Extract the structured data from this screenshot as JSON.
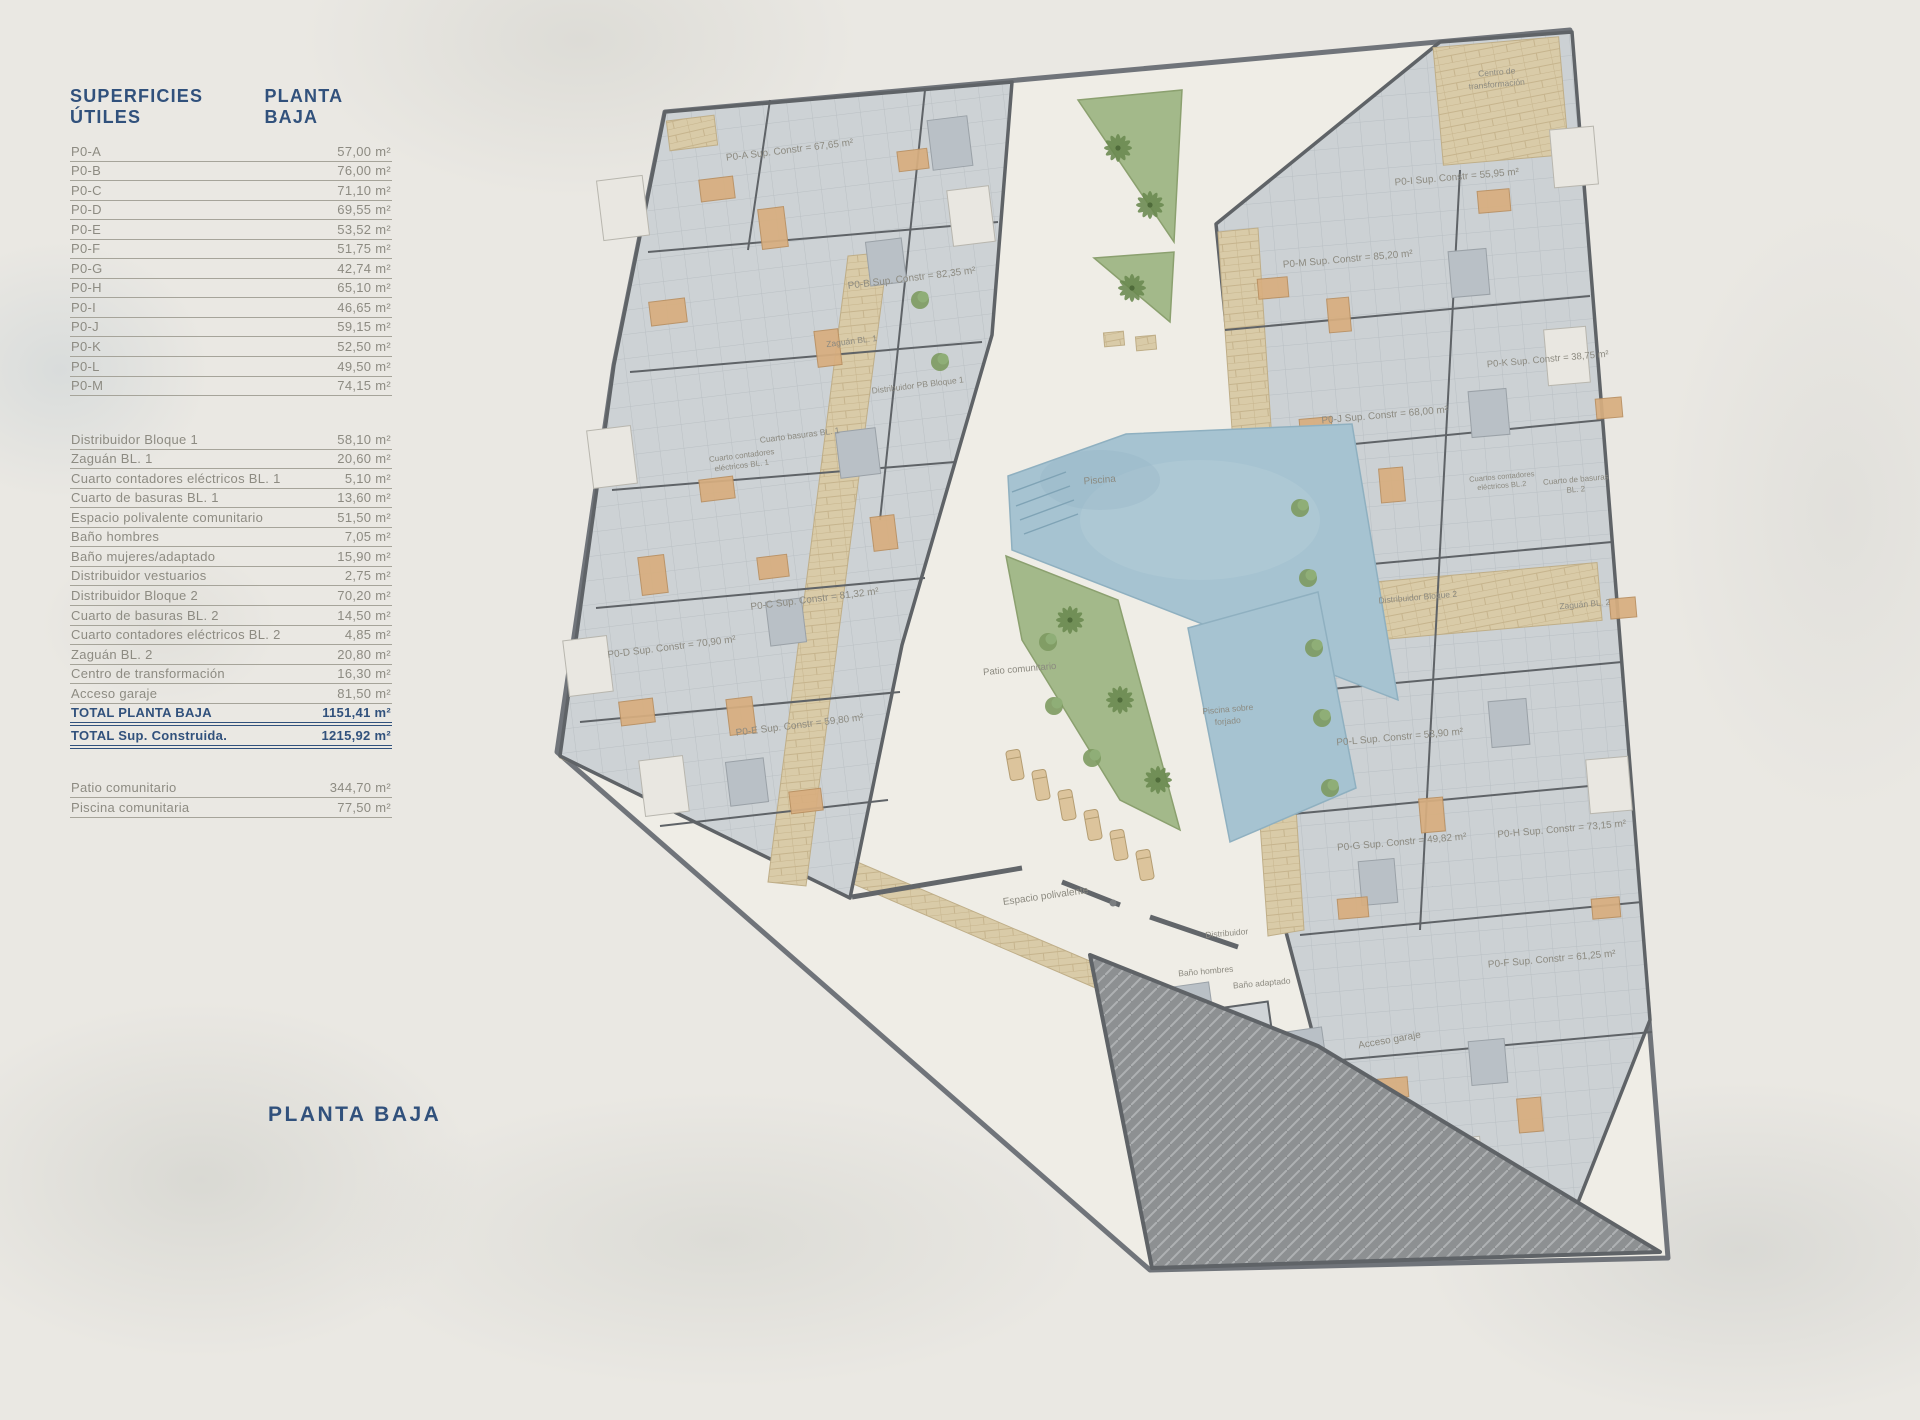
{
  "legend": {
    "title_left": "SUPERFICIES ÚTILES",
    "title_right": "PLANTA BAJA",
    "apartments": [
      {
        "label": "P0-A",
        "value": "57,00 m²"
      },
      {
        "label": "P0-B",
        "value": "76,00 m²"
      },
      {
        "label": "P0-C",
        "value": "71,10 m²"
      },
      {
        "label": "P0-D",
        "value": "69,55 m²"
      },
      {
        "label": "P0-E",
        "value": "53,52 m²"
      },
      {
        "label": "P0-F",
        "value": "51,75 m²"
      },
      {
        "label": "P0-G",
        "value": "42,74 m²"
      },
      {
        "label": "P0-H",
        "value": "65,10 m²"
      },
      {
        "label": "P0-I",
        "value": "46,65 m²"
      },
      {
        "label": "P0-J",
        "value": "59,15 m²"
      },
      {
        "label": "P0-K",
        "value": "52,50 m²"
      },
      {
        "label": "P0-L",
        "value": "49,50 m²"
      },
      {
        "label": "P0-M",
        "value": "74,15 m²"
      }
    ],
    "common": [
      {
        "label": "Distribuidor Bloque 1",
        "value": "58,10 m²"
      },
      {
        "label": "Zaguán BL. 1",
        "value": "20,60 m²"
      },
      {
        "label": "Cuarto contadores eléctricos BL. 1",
        "value": "5,10 m²"
      },
      {
        "label": "Cuarto de basuras BL. 1",
        "value": "13,60 m²"
      },
      {
        "label": "Espacio polivalente comunitario",
        "value": "51,50 m²"
      },
      {
        "label": "Baño hombres",
        "value": "7,05 m²"
      },
      {
        "label": "Baño mujeres/adaptado",
        "value": "15,90 m²"
      },
      {
        "label": "Distribuidor vestuarios",
        "value": "2,75 m²"
      },
      {
        "label": "Distribuidor Bloque 2",
        "value": "70,20 m²"
      },
      {
        "label": "Cuarto de basuras BL. 2",
        "value": "14,50 m²"
      },
      {
        "label": "Cuarto contadores eléctricos BL. 2",
        "value": "4,85 m²"
      },
      {
        "label": "Zaguán BL. 2",
        "value": "20,80 m²"
      },
      {
        "label": "Centro de transformación",
        "value": "16,30 m²"
      },
      {
        "label": "Acceso garaje",
        "value": "81,50 m²"
      }
    ],
    "totals": [
      {
        "label": "TOTAL PLANTA BAJA",
        "value": "1151,41 m²"
      },
      {
        "label": "TOTAL Sup. Construida.",
        "value": "1215,92 m²"
      }
    ],
    "outdoor": [
      {
        "label": "Patio comunitario",
        "value": "344,70 m²"
      },
      {
        "label": "Piscina comunitaria",
        "value": "77,50 m²"
      }
    ]
  },
  "footer_label": "PLANTA BAJA",
  "colors": {
    "navy": "#31517c",
    "table_gray": "#8d8b82",
    "background": "#eae8e3",
    "room_tile": "#cdd2d5",
    "walls": "#5f6367",
    "stone": "#d9cba8",
    "water": "#a6c3d1",
    "green": "#a3b98a",
    "garage": "#8d9092"
  },
  "plan_labels": [
    {
      "text": "P0-A Sup. Constr = 67,65 m²",
      "x": 790,
      "y": 153,
      "r": -7,
      "s": 10
    },
    {
      "text": "P0-B Sup. Constr = 82,35 m²",
      "x": 912,
      "y": 281,
      "r": -7,
      "s": 10
    },
    {
      "text": "Zaguán BL. 1",
      "x": 852,
      "y": 344,
      "r": -7,
      "s": 8.5
    },
    {
      "text": "Distribuidor PB Bloque 1",
      "x": 918,
      "y": 388,
      "r": -7,
      "s": 8.5
    },
    {
      "text": "Cuarto basuras BL. 1",
      "x": 800,
      "y": 438,
      "r": -7,
      "s": 8.5
    },
    {
      "text": "Cuarto contadores",
      "x": 742,
      "y": 458,
      "r": -7,
      "s": 8
    },
    {
      "text": "eléctricos BL. 1",
      "x": 742,
      "y": 468,
      "r": -7,
      "s": 8
    },
    {
      "text": "P0-C Sup. Constr = 81,32 m²",
      "x": 815,
      "y": 602,
      "r": -7,
      "s": 10
    },
    {
      "text": "P0-D Sup. Constr = 70,90 m²",
      "x": 672,
      "y": 650,
      "r": -7,
      "s": 10
    },
    {
      "text": "P0-E Sup. Constr = 59,80 m²",
      "x": 800,
      "y": 728,
      "r": -7,
      "s": 10
    },
    {
      "text": "Piscina",
      "x": 1100,
      "y": 483,
      "r": -5,
      "s": 10
    },
    {
      "text": "Piscina sobre",
      "x": 1228,
      "y": 712,
      "r": -5,
      "s": 8.5
    },
    {
      "text": "forjado",
      "x": 1228,
      "y": 724,
      "r": -5,
      "s": 8.5
    },
    {
      "text": "Patio comunitario",
      "x": 1020,
      "y": 672,
      "r": -5,
      "s": 9.5
    },
    {
      "text": "Espacio polivalente",
      "x": 1046,
      "y": 899,
      "r": -8,
      "s": 10
    },
    {
      "text": "Distribuidor",
      "x": 1227,
      "y": 936,
      "r": -5,
      "s": 8.5
    },
    {
      "text": "Baño hombres",
      "x": 1206,
      "y": 974,
      "r": -5,
      "s": 8.5
    },
    {
      "text": "Baño adaptado",
      "x": 1262,
      "y": 986,
      "r": -5,
      "s": 8.5
    },
    {
      "text": "Acceso garaje",
      "x": 1390,
      "y": 1043,
      "r": -10,
      "s": 10
    },
    {
      "text": "Centro de",
      "x": 1497,
      "y": 75,
      "r": -5,
      "s": 8.5
    },
    {
      "text": "transformación",
      "x": 1497,
      "y": 87,
      "r": -5,
      "s": 8.5
    },
    {
      "text": "P0-I Sup. Constr = 55,95 m²",
      "x": 1457,
      "y": 180,
      "r": -5,
      "s": 10
    },
    {
      "text": "P0-M Sup. Constr = 85,20 m²",
      "x": 1348,
      "y": 262,
      "r": -5,
      "s": 10
    },
    {
      "text": "P0-K Sup. Constr = 38,75 m²",
      "x": 1548,
      "y": 362,
      "r": -5,
      "s": 9.5
    },
    {
      "text": "P0-J Sup. Constr = 68,00 m²",
      "x": 1385,
      "y": 418,
      "r": -5,
      "s": 10
    },
    {
      "text": "Cuartos contadores",
      "x": 1502,
      "y": 479,
      "r": -5,
      "s": 7.5
    },
    {
      "text": "eléctricos BL.2",
      "x": 1502,
      "y": 488,
      "r": -5,
      "s": 7.5
    },
    {
      "text": "Cuarto de basuras",
      "x": 1576,
      "y": 482,
      "r": -5,
      "s": 8
    },
    {
      "text": "BL. 2",
      "x": 1576,
      "y": 492,
      "r": -5,
      "s": 8
    },
    {
      "text": "Distribuidor Bloque 2",
      "x": 1418,
      "y": 600,
      "r": -5,
      "s": 8.5
    },
    {
      "text": "Zaguán BL. 2",
      "x": 1585,
      "y": 607,
      "r": -5,
      "s": 8.5
    },
    {
      "text": "P0-L Sup. Constr = 53,90 m²",
      "x": 1400,
      "y": 740,
      "r": -5,
      "s": 10
    },
    {
      "text": "P0-G Sup. Constr = 49,82 m²",
      "x": 1402,
      "y": 845,
      "r": -5,
      "s": 10
    },
    {
      "text": "P0-H Sup. Constr = 73,15 m²",
      "x": 1562,
      "y": 832,
      "r": -5,
      "s": 10
    },
    {
      "text": "P0-F Sup. Constr = 61,25 m²",
      "x": 1552,
      "y": 962,
      "r": -5,
      "s": 10
    }
  ]
}
